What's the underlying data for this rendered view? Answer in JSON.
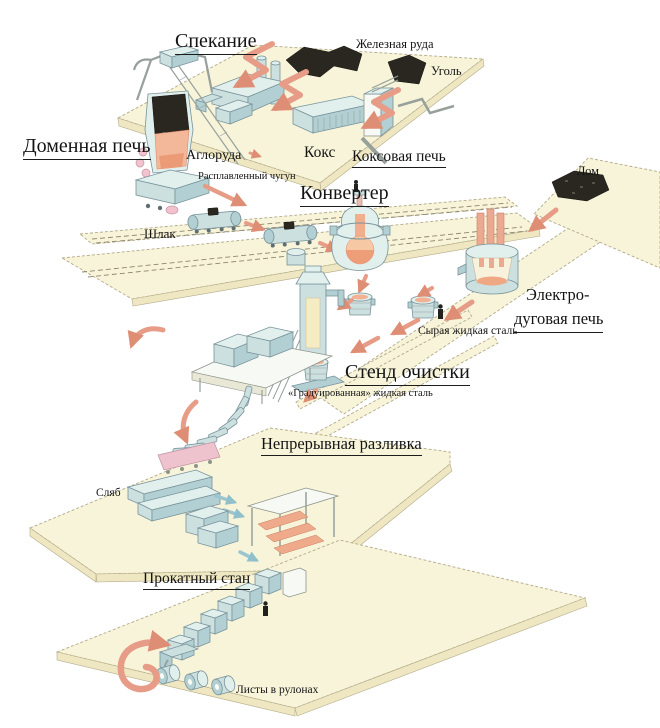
{
  "diagram": {
    "labels": {
      "sintering": "Спекание",
      "iron_ore": "Железная руда",
      "coal": "Уголь",
      "blast_furnace": "Доменная печь",
      "sinter_ore": "Аглоруда",
      "coke": "Кокс",
      "coke_oven": "Коксовая печь",
      "molten_iron": "Расплавленный чугун",
      "converter": "Конвертер",
      "scrap": "Лом",
      "slag": "Шлак",
      "eaf_line1": "Электро-",
      "eaf_line2": "дуговая печь",
      "raw_liquid_steel": "Сырая жидкая сталь",
      "refining_stand": "Стенд очистки",
      "graded_steel": "«Градуированная» жидкая сталь",
      "continuous_casting": "Непрерывная разливка",
      "slab": "Сляб",
      "rolling_mill": "Прокатный стан",
      "sheet_coils": "Листы в рулонах"
    },
    "colors": {
      "background": "#FFFFFF",
      "platform": "#F8F4D9",
      "platform_side": "#EFE7C1",
      "machine_light": "#E2F0ED",
      "machine_dark": "#B2D0D3",
      "arrow_salmon": "#E79C87",
      "ore_black": "#29271F",
      "molten_salmon": "#F2B193",
      "slab_pink": "#EEC3CE",
      "text": "#141414"
    }
  }
}
